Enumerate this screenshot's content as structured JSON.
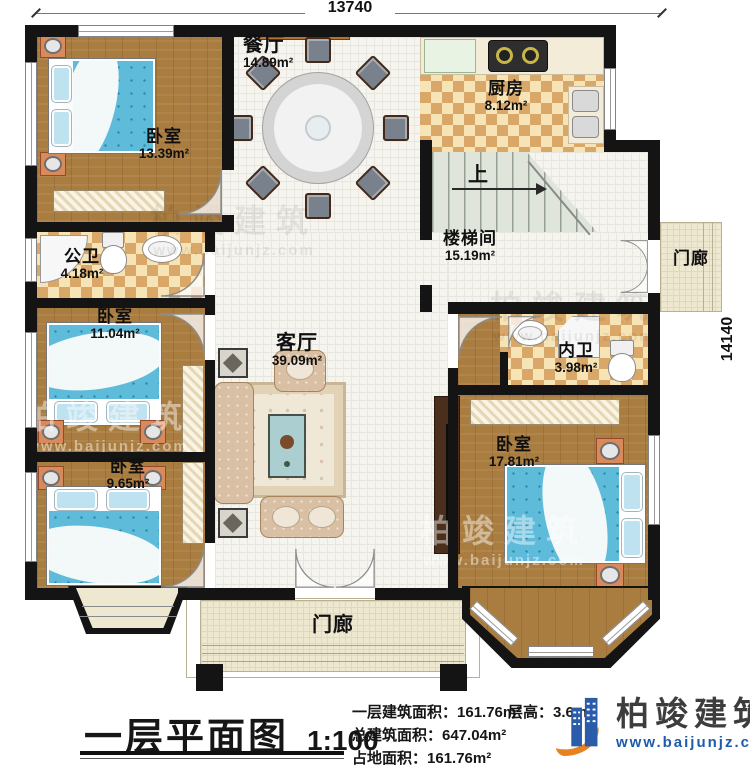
{
  "plan": {
    "dim_top": "13740",
    "dim_right": "14140",
    "rooms": {
      "bedroom_tl": {
        "name": "卧室",
        "area": "13.39m²"
      },
      "dining": {
        "name": "餐厅",
        "area": "14.89m²"
      },
      "kitchen": {
        "name": "厨房",
        "area": "8.12m²"
      },
      "stairwell": {
        "name": "楼梯间",
        "area": "15.19m²"
      },
      "stairs_dir": "上",
      "porch_right": {
        "name": "门廊"
      },
      "bath_public": {
        "name": "公卫",
        "area": "4.18m²"
      },
      "bedroom_ml": {
        "name": "卧室",
        "area": "11.04m²"
      },
      "bedroom_bl": {
        "name": "卧室",
        "area": "9.65m²"
      },
      "living": {
        "name": "客厅",
        "area": "39.09m²"
      },
      "bath_private": {
        "name": "内卫",
        "area": "3.98m²"
      },
      "bedroom_r": {
        "name": "卧室",
        "area": "17.81m²"
      },
      "porch_bottom": {
        "name": "门廊"
      }
    }
  },
  "caption": {
    "title": "一层平面图",
    "scale": "1:100"
  },
  "stats": {
    "floor_area_label": "一层建筑面积：",
    "floor_area_value": "161.76m²",
    "total_area_label": "总建筑面积：",
    "total_area_value": "647.04m²",
    "land_area_label": "占地面积：",
    "land_area_value": "161.76m²",
    "height_label": "层高：",
    "height_value": "3.6m"
  },
  "brand": {
    "name": "柏竣建筑",
    "website": "www.baijunjz.com"
  },
  "watermark": {
    "name": "柏竣建筑",
    "website": "www.baijunjz.com"
  },
  "colors": {
    "wall": "#141414",
    "wood_floor": "#a97c40",
    "tile_floor": "#f5f4ef",
    "checker_dark": "#d9a768",
    "checker_light": "#f7e4b6",
    "bed_blue": "#5fbbda",
    "sofa_tan": "#d9c0a4",
    "brand_blue": "#1d5cab",
    "brand_orange": "#e8821e"
  }
}
